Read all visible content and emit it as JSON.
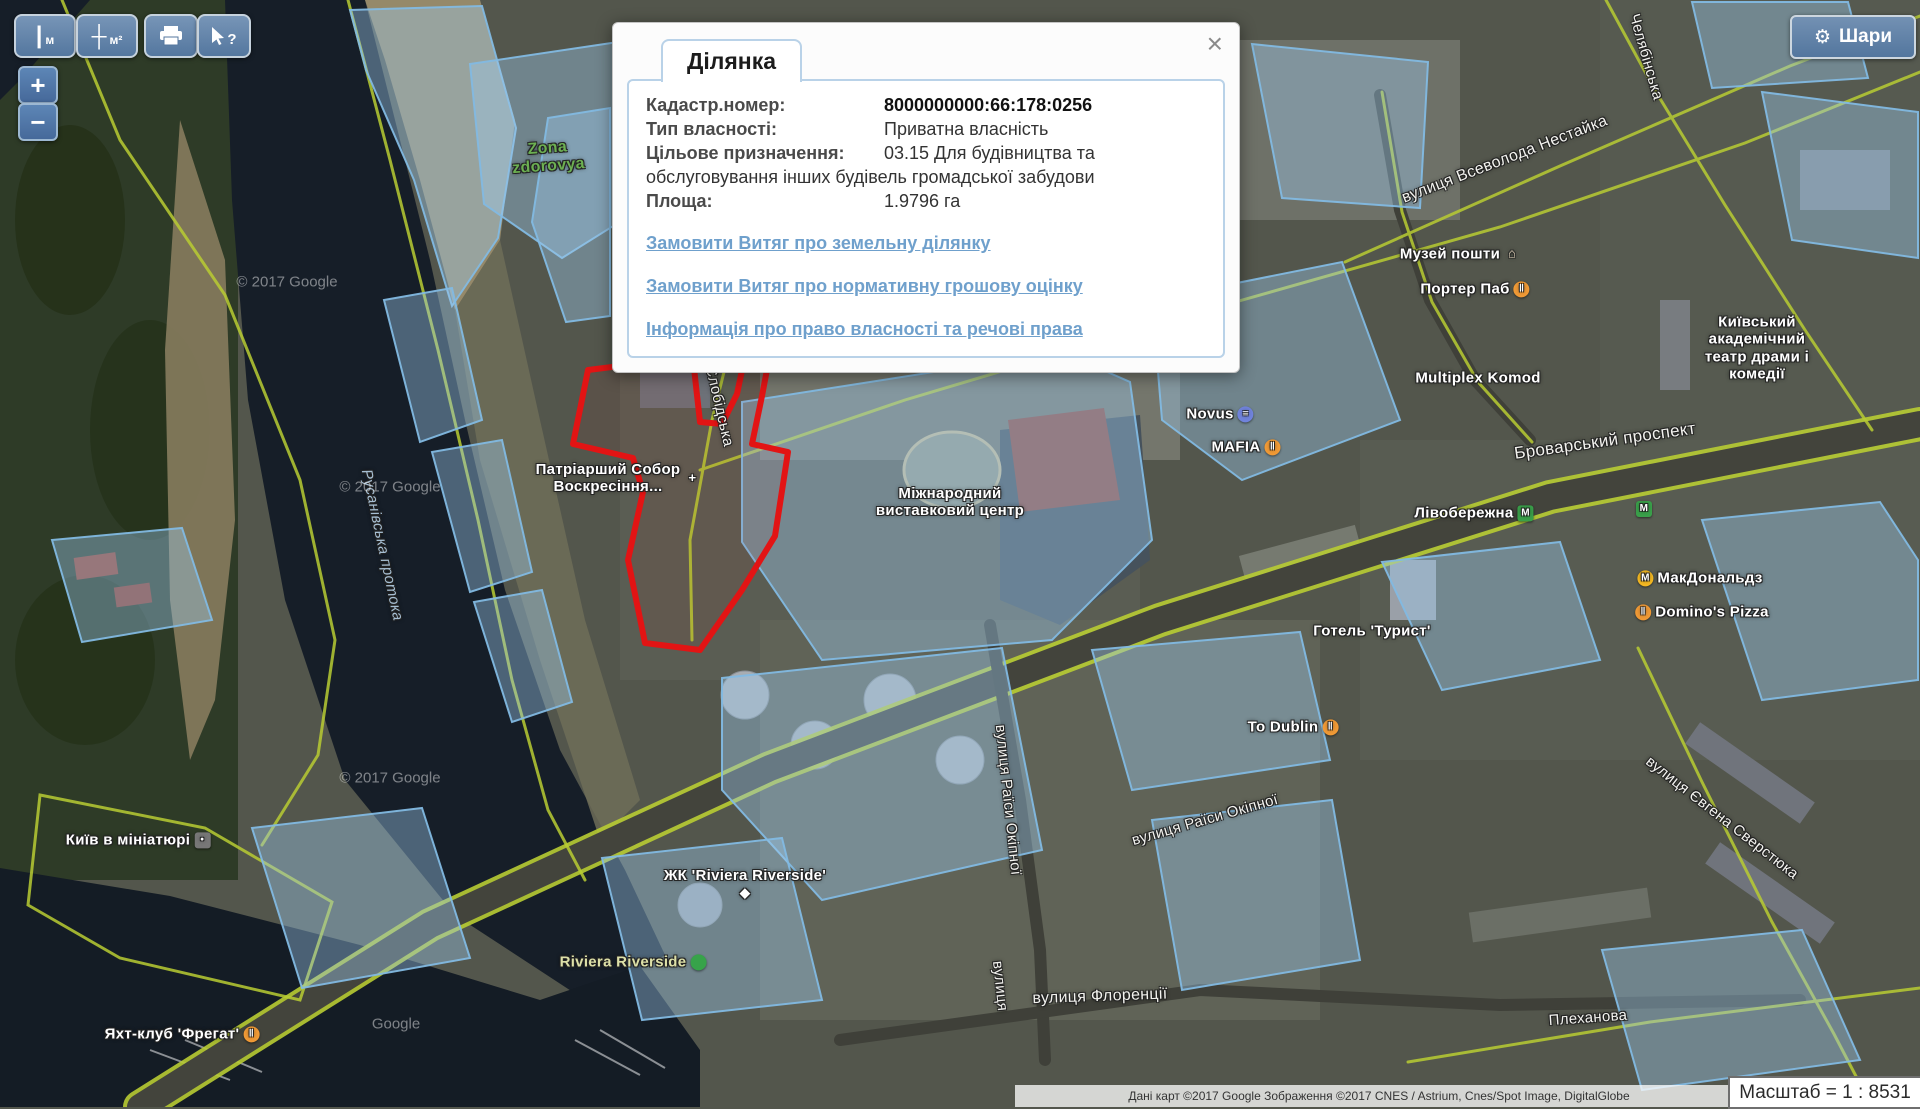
{
  "toolbar": {
    "measure_length_label": "м",
    "measure_area_label": "м²",
    "identify_label": "?"
  },
  "zoom_controls": {
    "zoom_in": "+",
    "zoom_out": "−"
  },
  "layers_button": {
    "label": "Шари",
    "gear_icon": "⚙"
  },
  "popup": {
    "tab_label": "Ділянка",
    "close_icon": "×",
    "fields": [
      {
        "label": "Кадастр.номер:",
        "value": "8000000000:66:178:0256"
      },
      {
        "label": "Тип власності:",
        "value": "Приватна власність"
      },
      {
        "label": "Цільове призначення:",
        "value": "03.15 Для будівництва та обслуговування інших будівель громадської забудови"
      },
      {
        "label": "Площа:",
        "value": "1.9796 га"
      }
    ],
    "links": [
      "Замовити Витяг про земельну ділянку",
      "Замовити Витяг про нормативну грошову оцінку",
      "Інформація про право власності та речові права"
    ]
  },
  "scale_indicator": {
    "text": "Масштаб = 1 : 8531"
  },
  "attribution": {
    "text": "Дані карт ©2017 Google  Зображення ©2017 CNES / Astrium, Cnes/Spot Image, DigitalGlobe"
  },
  "map": {
    "colors": {
      "selected_parcel_outline": "#e21414",
      "cadastral_parcel_fill": "rgba(158,202,238,0.4)",
      "cadastral_parcel_stroke": "#82b9e1",
      "road_line": "#b8cc33",
      "water": "#161e28"
    },
    "labels": [
      {
        "name": "zona-zdorovya",
        "text": "Zona\nzdorovya",
        "x": 548,
        "y": 158,
        "rot": -4,
        "cls": "green-lbl"
      },
      {
        "name": "rusanivska-protoka",
        "text": "Русанівська протока",
        "x": 382,
        "y": 545,
        "rot": 78,
        "cls": "water-lbl"
      },
      {
        "name": "patriarchal-cathedral",
        "text": "Патріарший Собор\nВоскресіння...",
        "x": 618,
        "y": 478,
        "rot": 0,
        "cls": "poi",
        "icon": {
          "glyph": "+",
          "bg": "transparent",
          "flat": true,
          "pos": "right"
        }
      },
      {
        "name": "kredobank",
        "text": "Кредобанк",
        "x": 975,
        "y": 339,
        "rot": 0,
        "cls": "poi",
        "icon": {
          "glyph": "₴",
          "bg": "#4d7fd6",
          "sq": true,
          "pos": "right"
        }
      },
      {
        "name": "mykilsko-slobidska-street",
        "text": "вулиця Микільсько-Слобідська",
        "x": 1085,
        "y": 328,
        "rot": -13,
        "cls": "street",
        "fs": 16
      },
      {
        "name": "slobidska-street-vertical",
        "text": "ько-Слобідська",
        "x": 716,
        "y": 392,
        "rot": 77,
        "cls": "street"
      },
      {
        "name": "vsevoloda-nestayka-street",
        "text": "вулиця Всеволода Нестайка",
        "x": 1505,
        "y": 160,
        "rot": -21,
        "cls": "street",
        "fs": 16
      },
      {
        "name": "cheliabinska-street",
        "text": "Челябінська",
        "x": 1646,
        "y": 57,
        "rot": 74,
        "cls": "street"
      },
      {
        "name": "postal-museum",
        "text": "Музей пошти",
        "x": 1460,
        "y": 254,
        "rot": 0,
        "cls": "poi",
        "icon": {
          "glyph": "⌂",
          "bg": "transparent",
          "flat": true,
          "color": "#e3d2bb",
          "pos": "right"
        }
      },
      {
        "name": "porter-pub",
        "text": "Портер Паб",
        "x": 1475,
        "y": 289,
        "rot": 0,
        "cls": "poi",
        "icon": {
          "glyph": "‖",
          "bg": "#f09a36",
          "pos": "right"
        }
      },
      {
        "name": "drama-theater",
        "text": "Київський академічний\nтеатр драми і комедії",
        "x": 1757,
        "y": 348,
        "rot": 0,
        "cls": "poi"
      },
      {
        "name": "multiplex-komod",
        "text": "Multiplex Komod",
        "x": 1478,
        "y": 378,
        "rot": 0,
        "cls": "poi"
      },
      {
        "name": "novus",
        "text": "Novus",
        "x": 1220,
        "y": 414,
        "rot": 0,
        "cls": "poi",
        "icon": {
          "glyph": "≡",
          "bg": "#7083dc",
          "pos": "right"
        }
      },
      {
        "name": "mafia",
        "text": "MAFIA",
        "x": 1246,
        "y": 447,
        "rot": 0,
        "cls": "poi",
        "icon": {
          "glyph": "‖",
          "bg": "#f09a36",
          "pos": "right"
        }
      },
      {
        "name": "exhibition-center",
        "text": "Міжнародний\nвиставковий центр",
        "x": 950,
        "y": 502,
        "rot": 0,
        "cls": "poi"
      },
      {
        "name": "brovarskyi-prospekt",
        "text": "Броварський проспект",
        "x": 1605,
        "y": 441,
        "rot": -8,
        "cls": "street",
        "fs": 17
      },
      {
        "name": "livoberezhna",
        "text": "Лівобережна",
        "x": 1474,
        "y": 513,
        "rot": 0,
        "cls": "poi",
        "icon": {
          "glyph": "М",
          "bg": "#3aa04a",
          "sq": true,
          "pos": "right"
        }
      },
      {
        "name": "metro-icon-2",
        "text": "",
        "x": 1642,
        "y": 509,
        "rot": 0,
        "cls": "poi",
        "icon": {
          "glyph": "М",
          "bg": "#3aa04a",
          "sq": true,
          "pos": "right"
        }
      },
      {
        "name": "mcdonalds",
        "text": "МакДональдз",
        "x": 1700,
        "y": 578,
        "rot": 0,
        "cls": "poi",
        "icon": {
          "glyph": "М",
          "bg": "#f5b922",
          "pos": "left"
        }
      },
      {
        "name": "dominos-pizza",
        "text": "Domino's Pizza",
        "x": 1702,
        "y": 612,
        "rot": 0,
        "cls": "poi",
        "icon": {
          "glyph": "‖",
          "bg": "#f09a36",
          "pos": "left"
        }
      },
      {
        "name": "hotel-tourist",
        "text": "Готель 'Турист'",
        "x": 1372,
        "y": 631,
        "rot": 0,
        "cls": "poi"
      },
      {
        "name": "to-dublin",
        "text": "To Dublin",
        "x": 1293,
        "y": 727,
        "rot": 0,
        "cls": "poi",
        "icon": {
          "glyph": "‖",
          "bg": "#f09a36",
          "pos": "right"
        }
      },
      {
        "name": "raisy-okipnoi-street-vertical",
        "text": "вулиця Раїси Окіпної",
        "x": 1008,
        "y": 800,
        "rot": 84,
        "cls": "street"
      },
      {
        "name": "raisy-okipnoi-street",
        "text": "вулиця Раїси Окіпної",
        "x": 1205,
        "y": 820,
        "rot": -16,
        "cls": "street"
      },
      {
        "name": "yevhena-sverstiuka-street",
        "text": "вулиця Євгена Сверстюка",
        "x": 1722,
        "y": 818,
        "rot": 38,
        "cls": "street"
      },
      {
        "name": "zhk-riviera-riverside",
        "text": "ЖК 'Riviera Riverside'",
        "x": 745,
        "y": 884,
        "rot": 0,
        "cls": "poi",
        "icon": {
          "glyph": "◆",
          "bg": "transparent",
          "flat": true,
          "pos": "below"
        }
      },
      {
        "name": "riviera-riverside",
        "text": "Riviera Riverside",
        "x": 633,
        "y": 962,
        "rot": 0,
        "cls": "yellow-lbl",
        "icon": {
          "glyph": "",
          "bg": "#37a34a",
          "pos": "right"
        }
      },
      {
        "name": "florentsii-street",
        "text": "вулиця Флоренції",
        "x": 1100,
        "y": 997,
        "rot": -2,
        "cls": "street",
        "fs": 16
      },
      {
        "name": "plekhanova-street",
        "text": "Плеханова",
        "x": 1588,
        "y": 1018,
        "rot": -4,
        "cls": "street"
      },
      {
        "name": "yacht-club-fregat",
        "text": "Яхт-клуб 'Фрегат'",
        "x": 182,
        "y": 1034,
        "rot": 0,
        "cls": "poi",
        "icon": {
          "glyph": "‖",
          "bg": "#f09a36",
          "pos": "right"
        }
      },
      {
        "name": "kyiv-in-miniature",
        "text": "Київ в мініатюрі",
        "x": 138,
        "y": 840,
        "rot": 0,
        "cls": "poi",
        "icon": {
          "glyph": "•",
          "bg": "#777777",
          "sq": true,
          "pos": "right"
        }
      },
      {
        "name": "vulytsia-fragment",
        "text": "вулиця",
        "x": 1000,
        "y": 986,
        "rot": 84,
        "cls": "street"
      }
    ],
    "watermarks": [
      {
        "text": "© 2017 Google",
        "x": 287,
        "y": 282
      },
      {
        "text": "© 2017 Google",
        "x": 390,
        "y": 487
      },
      {
        "text": "© 2017 Google",
        "x": 390,
        "y": 778
      },
      {
        "text": "Google",
        "x": 396,
        "y": 1024
      }
    ]
  }
}
